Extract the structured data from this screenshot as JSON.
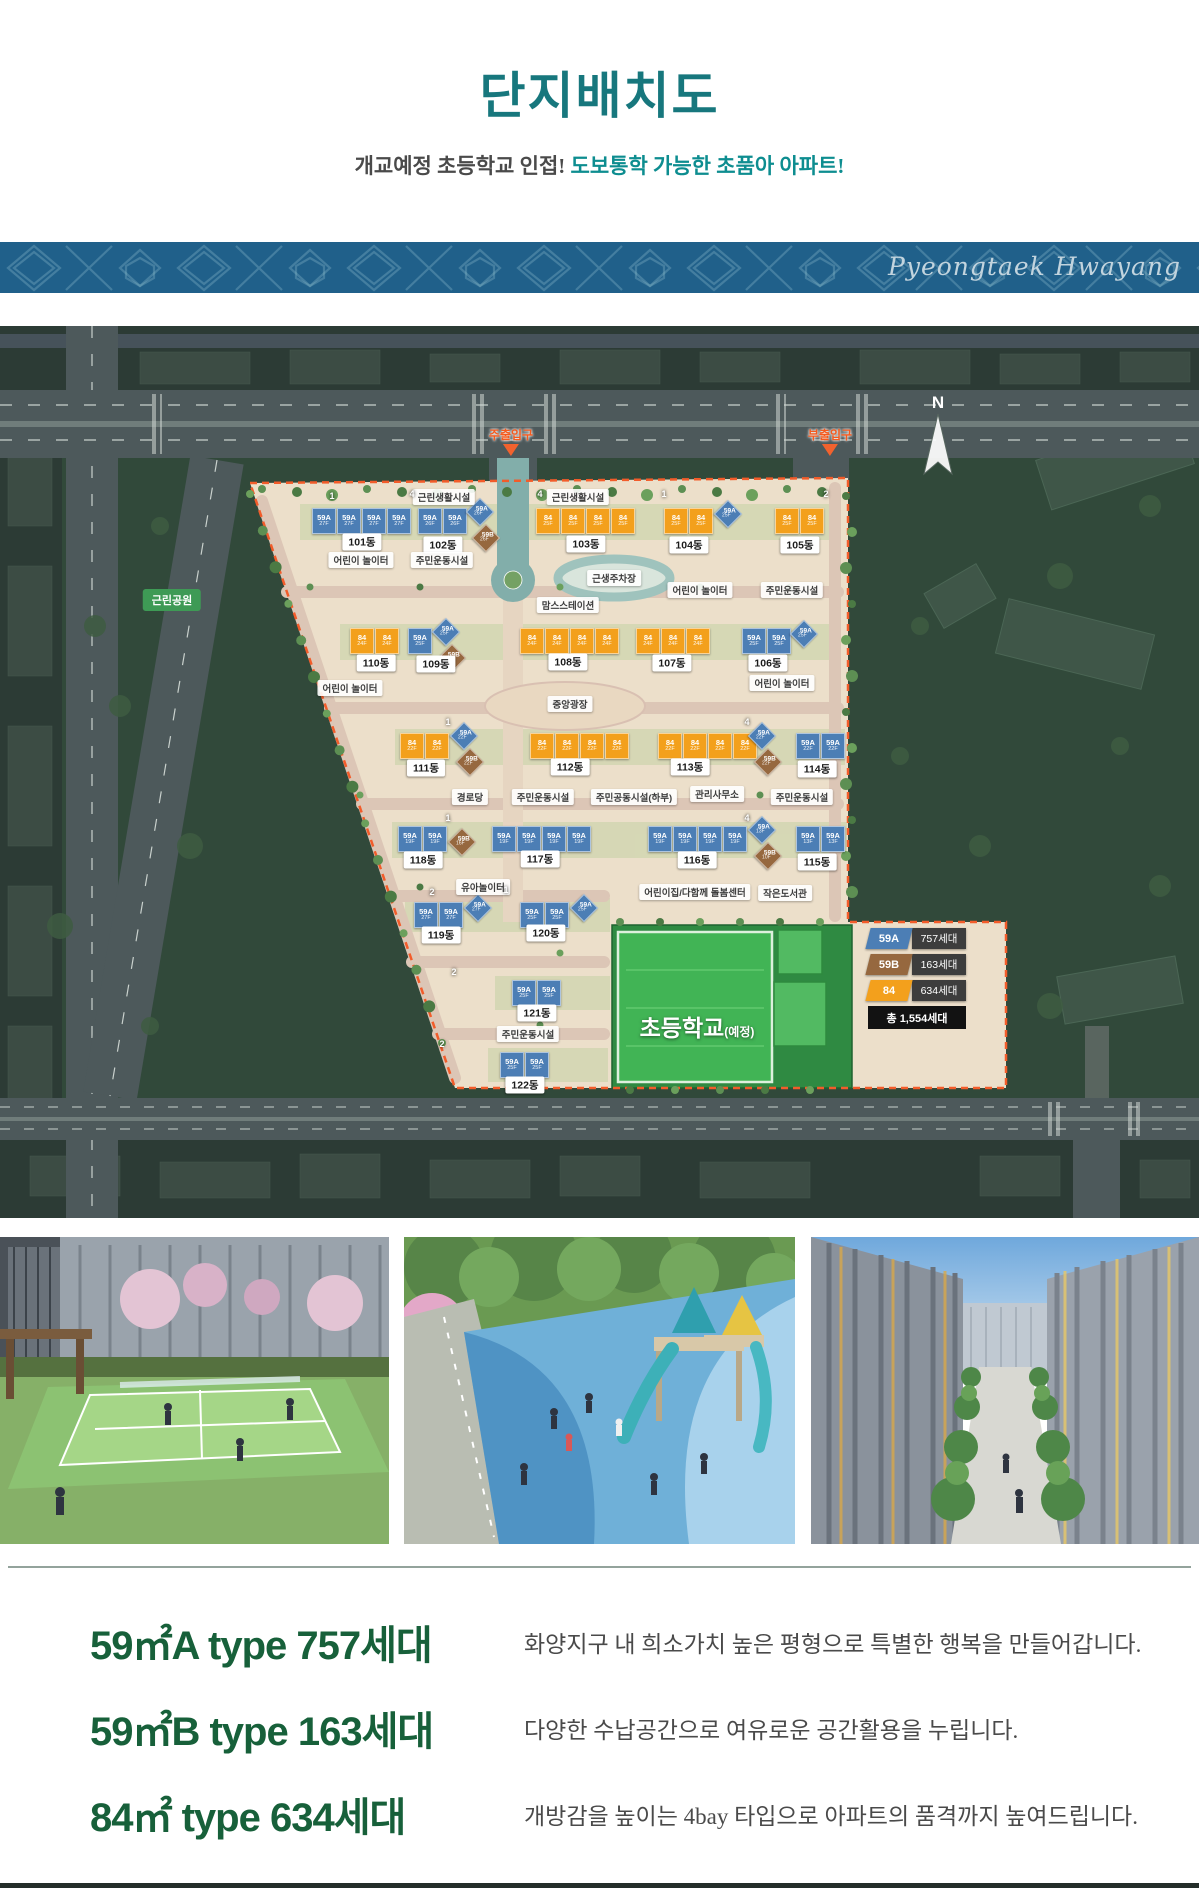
{
  "header": {
    "title": "단지배치도",
    "subtitle_plain": "개교예정 초등학교 인접!",
    "subtitle_accent": " 도보통학 가능한 초품아 아파트!"
  },
  "banner": {
    "brand": "Pyeongtaek Hwayang",
    "bg": "#20608a"
  },
  "map": {
    "compass": "N",
    "park_label": "근린공원",
    "school": {
      "label": "초등학교",
      "suffix": "(예정)"
    },
    "entrances": [
      {
        "label": "주출입구",
        "x": 511
      },
      {
        "label": "부출입구",
        "x": 830
      }
    ],
    "type_colors": {
      "59A": "#4c7eb5",
      "59B": "#96683f",
      "84": "#f3a01c"
    },
    "legend": {
      "items": [
        {
          "type": "59A",
          "value": "757세대",
          "color": "#4c7eb5"
        },
        {
          "type": "59B",
          "value": "163세대",
          "color": "#96683f"
        },
        {
          "type": "84",
          "value": "634세대",
          "color": "#f3a01c"
        }
      ],
      "total": "총 1,554세대"
    },
    "buildings": [
      {
        "badge": [
          "101동",
          362,
          216
        ],
        "units": [
          [
            "59A",
            "27F",
            "r",
            312,
            182
          ],
          [
            "59A",
            "27F",
            "r",
            337,
            182
          ],
          [
            "59A",
            "27F",
            "r",
            362,
            182
          ],
          [
            "59A",
            "27F",
            "r",
            387,
            182
          ]
        ]
      },
      {
        "badge": [
          "102동",
          443,
          219
        ],
        "units": [
          [
            "59A",
            "26F",
            "r",
            418,
            182
          ],
          [
            "59A",
            "26F",
            "r",
            443,
            182
          ],
          [
            "59A",
            "26F",
            "d",
            470,
            176
          ],
          [
            "59B",
            "26F",
            "d",
            476,
            202
          ]
        ]
      },
      {
        "badge": [
          "103동",
          586,
          218
        ],
        "units": [
          [
            "84",
            "25F",
            "r",
            536,
            182
          ],
          [
            "84",
            "25F",
            "r",
            561,
            182
          ],
          [
            "84",
            "25F",
            "r",
            586,
            182
          ],
          [
            "84",
            "25F",
            "r",
            611,
            182
          ]
        ]
      },
      {
        "badge": [
          "104동",
          689,
          219
        ],
        "units": [
          [
            "84",
            "25F",
            "r",
            664,
            182
          ],
          [
            "84",
            "25F",
            "r",
            689,
            182
          ],
          [
            "59A",
            "25F",
            "d",
            718,
            178
          ]
        ]
      },
      {
        "badge": [
          "105동",
          800,
          219
        ],
        "units": [
          [
            "84",
            "25F",
            "r",
            775,
            182
          ],
          [
            "84",
            "25F",
            "r",
            800,
            182
          ]
        ]
      },
      {
        "badge": [
          "110동",
          376,
          337
        ],
        "units": [
          [
            "84",
            "24F",
            "r",
            350,
            302
          ],
          [
            "84",
            "24F",
            "r",
            375,
            302
          ]
        ]
      },
      {
        "badge": [
          "109동",
          436,
          338
        ],
        "units": [
          [
            "59A",
            "25F",
            "r",
            408,
            302
          ],
          [
            "59A",
            "25F",
            "d",
            436,
            296
          ],
          [
            "59B",
            "22F",
            "d",
            442,
            322
          ]
        ]
      },
      {
        "badge": [
          "108동",
          568,
          336
        ],
        "units": [
          [
            "84",
            "24F",
            "r",
            520,
            302
          ],
          [
            "84",
            "24F",
            "r",
            545,
            302
          ],
          [
            "84",
            "24F",
            "r",
            570,
            302
          ],
          [
            "84",
            "24F",
            "r",
            595,
            302
          ]
        ]
      },
      {
        "badge": [
          "107동",
          672,
          337
        ],
        "units": [
          [
            "84",
            "24F",
            "r",
            636,
            302
          ],
          [
            "84",
            "24F",
            "r",
            661,
            302
          ],
          [
            "84",
            "24F",
            "r",
            686,
            302
          ]
        ]
      },
      {
        "badge": [
          "106동",
          768,
          337
        ],
        "units": [
          [
            "59A",
            "25F",
            "r",
            742,
            302
          ],
          [
            "59A",
            "25F",
            "r",
            767,
            302
          ],
          [
            "59A",
            "25F",
            "d",
            794,
            298
          ]
        ]
      },
      {
        "badge": [
          "111동",
          426,
          442
        ],
        "units": [
          [
            "84",
            "22F",
            "r",
            400,
            407
          ],
          [
            "84",
            "22F",
            "r",
            425,
            407
          ],
          [
            "59A",
            "22F",
            "d",
            454,
            400
          ],
          [
            "59B",
            "22F",
            "d",
            460,
            426
          ]
        ]
      },
      {
        "badge": [
          "112동",
          570,
          441
        ],
        "units": [
          [
            "84",
            "22F",
            "r",
            530,
            407
          ],
          [
            "84",
            "22F",
            "r",
            555,
            407
          ],
          [
            "84",
            "22F",
            "r",
            580,
            407
          ],
          [
            "84",
            "22F",
            "r",
            605,
            407
          ]
        ]
      },
      {
        "badge": [
          "113동",
          690,
          441
        ],
        "units": [
          [
            "84",
            "22F",
            "r",
            658,
            407
          ],
          [
            "84",
            "22F",
            "r",
            683,
            407
          ],
          [
            "84",
            "22F",
            "r",
            708,
            407
          ],
          [
            "84",
            "22F",
            "r",
            733,
            407
          ]
        ]
      },
      {
        "badge": [
          "114동",
          817,
          443
        ],
        "units": [
          [
            "59A",
            "22F",
            "d",
            752,
            400
          ],
          [
            "59B",
            "22F",
            "d",
            758,
            426
          ],
          [
            "59A",
            "22F",
            "r",
            796,
            407
          ],
          [
            "59A",
            "22F",
            "r",
            821,
            407
          ]
        ]
      },
      {
        "badge": [
          "118동",
          423,
          534
        ],
        "units": [
          [
            "59A",
            "19F",
            "r",
            398,
            500
          ],
          [
            "59A",
            "19F",
            "r",
            423,
            500
          ],
          [
            "59B",
            "16F",
            "d",
            452,
            506
          ]
        ]
      },
      {
        "badge": [
          "117동",
          540,
          533
        ],
        "units": [
          [
            "59A",
            "19F",
            "r",
            492,
            500
          ],
          [
            "59A",
            "19F",
            "r",
            517,
            500
          ],
          [
            "59A",
            "19F",
            "r",
            542,
            500
          ],
          [
            "59A",
            "19F",
            "r",
            567,
            500
          ]
        ]
      },
      {
        "badge": [
          "116동",
          697,
          534
        ],
        "units": [
          [
            "59A",
            "19F",
            "r",
            648,
            500
          ],
          [
            "59A",
            "19F",
            "r",
            673,
            500
          ],
          [
            "59A",
            "19F",
            "r",
            698,
            500
          ],
          [
            "59A",
            "19F",
            "r",
            723,
            500
          ]
        ]
      },
      {
        "badge": [
          "115동",
          817,
          536
        ],
        "units": [
          [
            "59A",
            "13F",
            "d",
            752,
            494
          ],
          [
            "59B",
            "10F",
            "d",
            758,
            520
          ],
          [
            "59A",
            "13F",
            "r",
            796,
            500
          ],
          [
            "59A",
            "13F",
            "r",
            821,
            500
          ]
        ]
      },
      {
        "badge": [
          "119동",
          441,
          609
        ],
        "units": [
          [
            "59A",
            "27F",
            "r",
            414,
            576
          ],
          [
            "59A",
            "27F",
            "r",
            439,
            576
          ],
          [
            "59A",
            "27F",
            "d",
            468,
            572
          ]
        ]
      },
      {
        "badge": [
          "120동",
          546,
          607
        ],
        "units": [
          [
            "59A",
            "25F",
            "r",
            520,
            576
          ],
          [
            "59A",
            "25F",
            "r",
            545,
            576
          ],
          [
            "59A",
            "25F",
            "d",
            574,
            572
          ]
        ]
      },
      {
        "badge": [
          "121동",
          537,
          687
        ],
        "units": [
          [
            "59A",
            "25F",
            "r",
            512,
            654
          ],
          [
            "59A",
            "25F",
            "r",
            537,
            654
          ]
        ]
      },
      {
        "badge": [
          "122동",
          525,
          759
        ],
        "units": [
          [
            "59A",
            "25F",
            "r",
            500,
            726
          ],
          [
            "59A",
            "25F",
            "r",
            525,
            726
          ]
        ]
      }
    ],
    "facilities": [
      [
        "근린생활시설",
        444,
        171
      ],
      [
        "근린생활시설",
        578,
        171
      ],
      [
        "어린이 놀이터",
        361,
        234
      ],
      [
        "주민운동시설",
        442,
        234
      ],
      [
        "근생주차장",
        614,
        252
      ],
      [
        "어린이 놀이터",
        700,
        264
      ],
      [
        "주민운동시설",
        792,
        264
      ],
      [
        "맘스스테이션",
        568,
        279
      ],
      [
        "어린이 놀이터",
        350,
        362
      ],
      [
        "중앙광장",
        570,
        378
      ],
      [
        "어린이 놀이터",
        782,
        357
      ],
      [
        "경로당",
        470,
        471
      ],
      [
        "주민운동시설",
        543,
        471
      ],
      [
        "주민공동시설(하부)",
        634,
        471
      ],
      [
        "관리사무소",
        717,
        468
      ],
      [
        "주민운동시설",
        802,
        471
      ],
      [
        "유아놀이터",
        483,
        561
      ],
      [
        "어린이집/다함께 돌봄센터",
        695,
        566
      ],
      [
        "작은도서관",
        785,
        567
      ],
      [
        "주민운동시설",
        528,
        708
      ]
    ],
    "markers": [
      [
        "1",
        332,
        170
      ],
      [
        "4",
        412,
        168
      ],
      [
        "4",
        540,
        168
      ],
      [
        "1",
        664,
        168
      ],
      [
        "2",
        826,
        168
      ],
      [
        "1",
        448,
        396
      ],
      [
        "4",
        747,
        396
      ],
      [
        "1",
        448,
        492
      ],
      [
        "4",
        747,
        492
      ],
      [
        "2",
        432,
        566
      ],
      [
        "1",
        506,
        564
      ],
      [
        "2",
        454,
        646
      ],
      [
        "2",
        442,
        718
      ]
    ]
  },
  "photos": [
    {
      "name": "tennis-court-photo"
    },
    {
      "name": "playground-photo"
    },
    {
      "name": "street-walkway-photo"
    }
  ],
  "types": [
    {
      "title": "59㎡A type 757세대",
      "desc": "화양지구 내 희소가치 높은 평형으로 특별한 행복을 만들어갑니다."
    },
    {
      "title": "59㎡B type 163세대",
      "desc": "다양한 수납공간으로 여유로운 공간활용을 누립니다."
    },
    {
      "title": "84㎡ type 634세대",
      "desc": "개방감을 높이는 4bay 타입으로 아파트의 품격까지 높여드립니다."
    }
  ]
}
